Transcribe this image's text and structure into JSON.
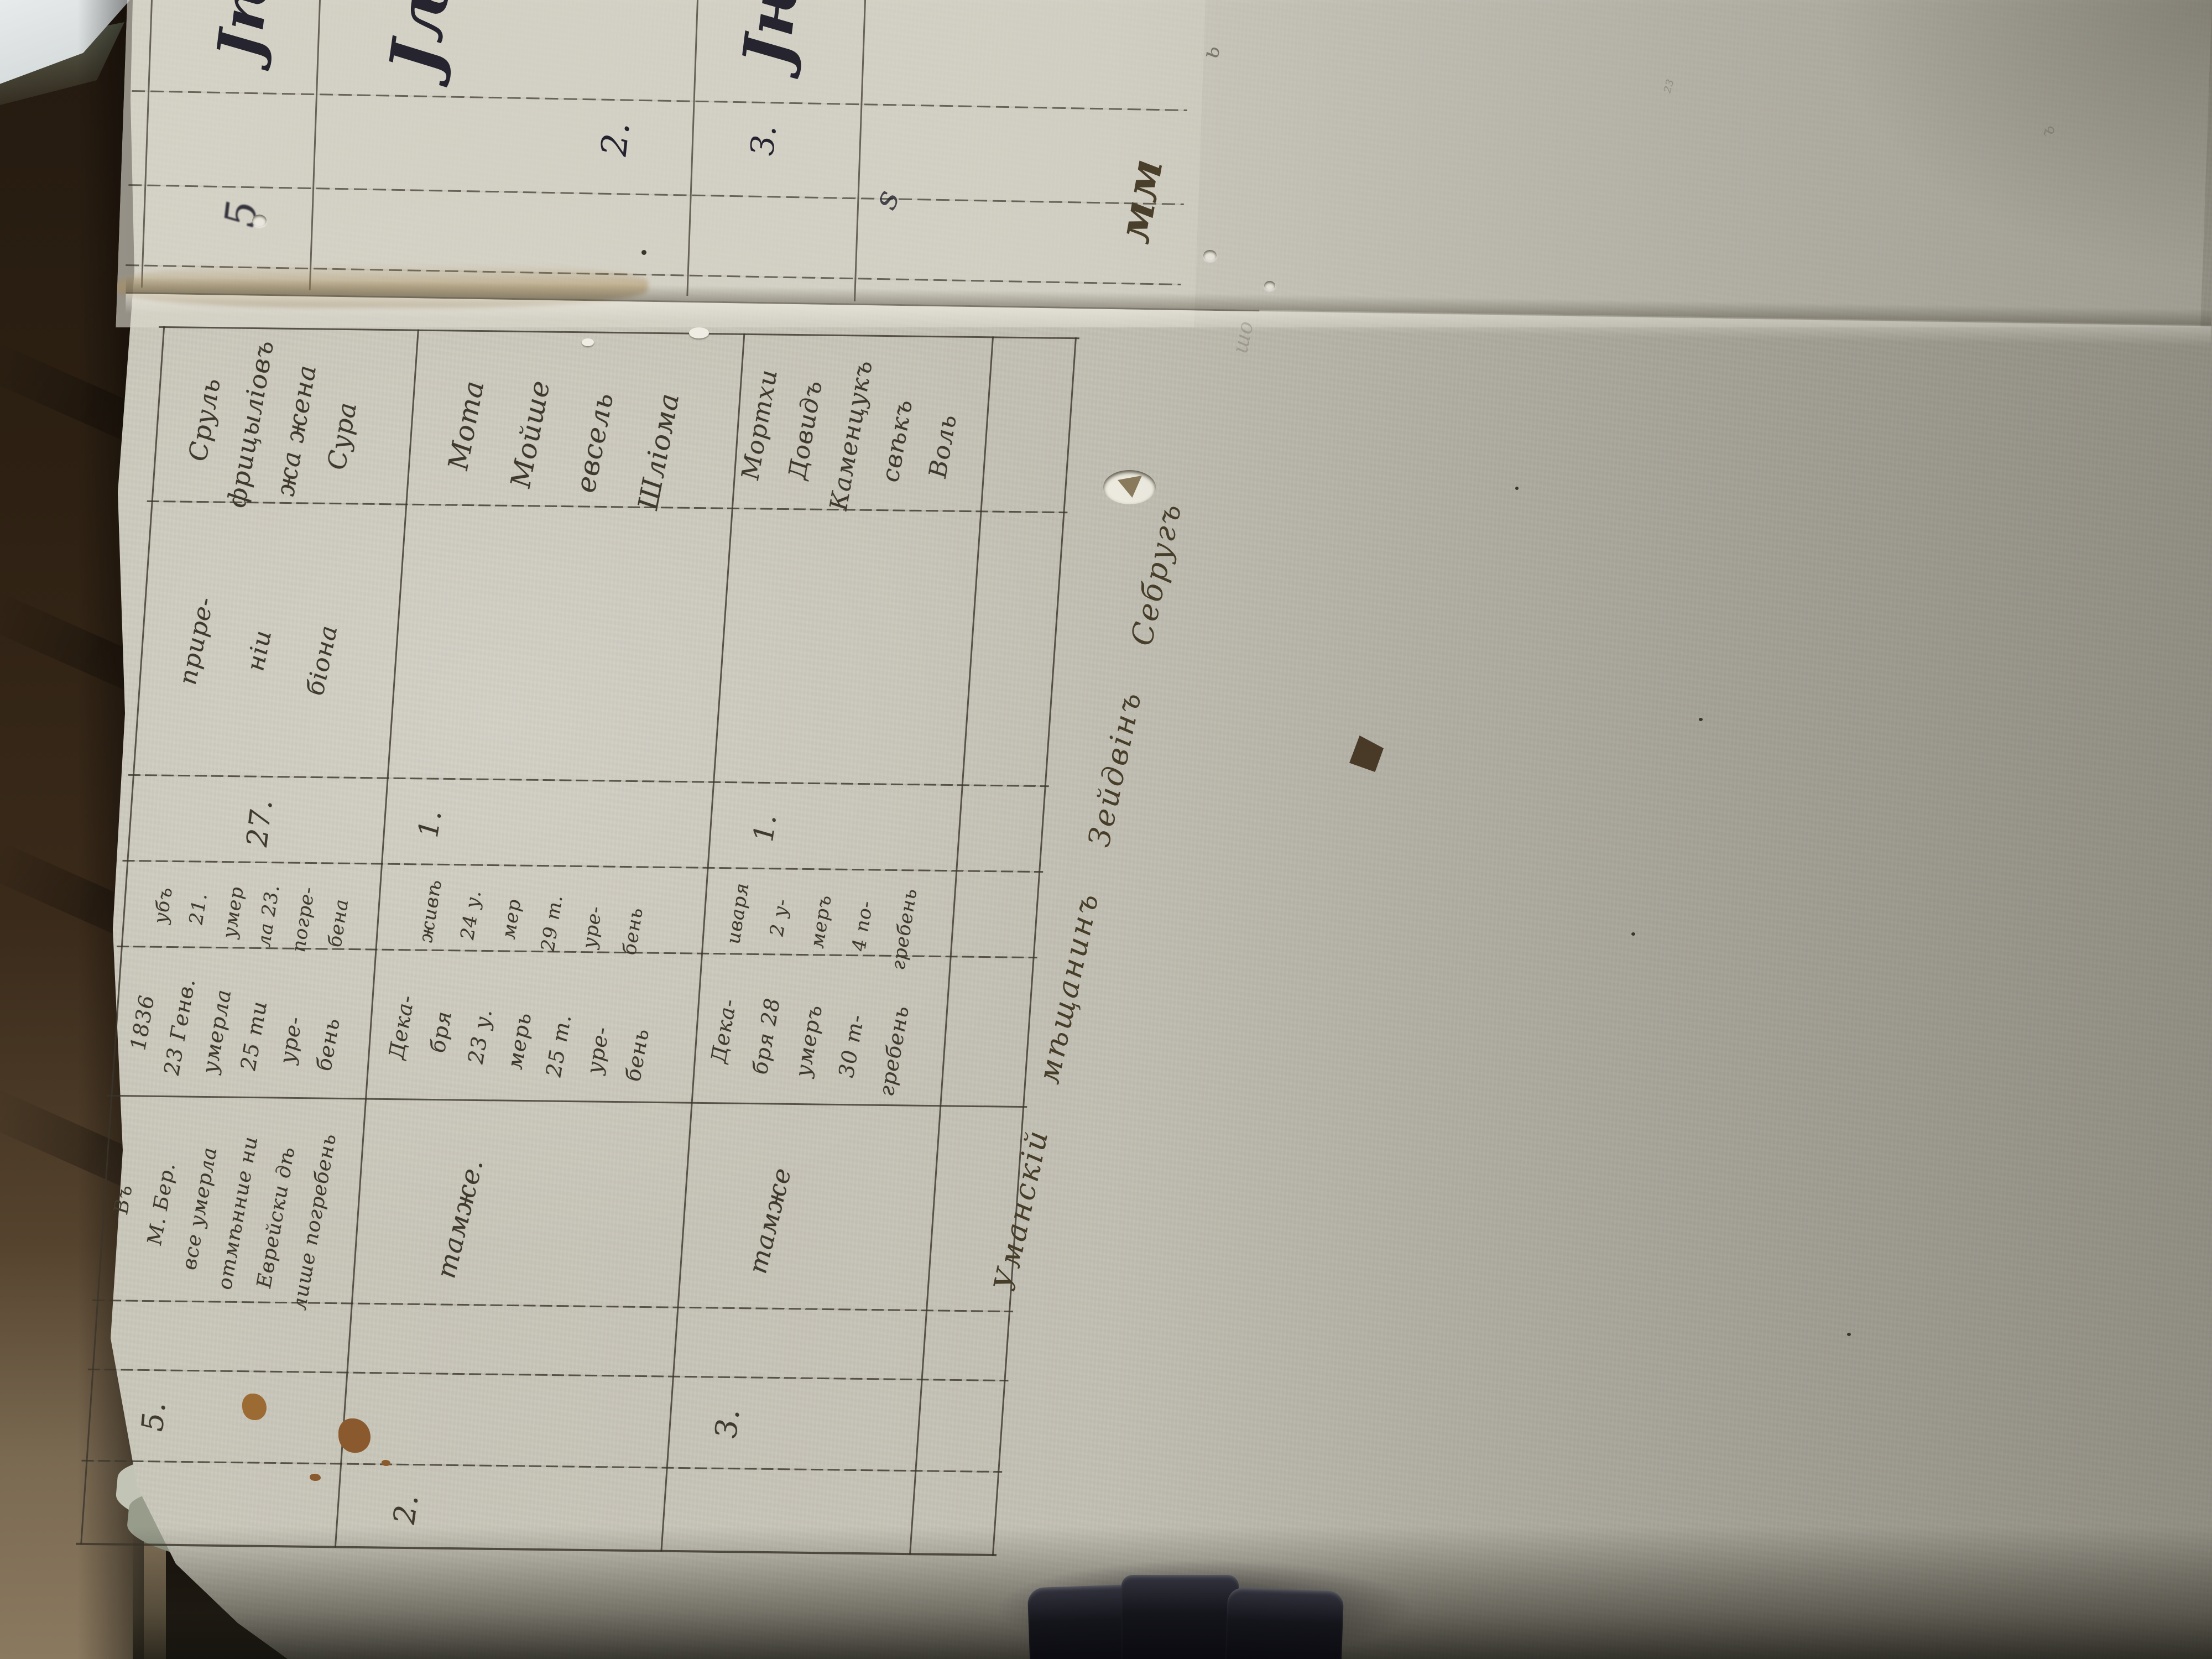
{
  "page": {
    "table": {
      "header": {
        "no": "5.",
        "place_lines": [
          "Въ",
          "М. Бер.",
          "все умерла",
          "отмѣнние ни",
          "Еврейски дѣ",
          "лише погребень"
        ],
        "death_lines": [
          "1836",
          "23 Генв.",
          "умерла",
          "25 ти",
          "уре-",
          "бень"
        ],
        "burial_lines": [
          "убъ",
          "21.",
          "умер",
          "ла 23.",
          "погре-",
          "бена"
        ],
        "count": "27.",
        "cause_lines": [
          "прире-",
          "ніи",
          "біона"
        ],
        "name_lines": [
          "Сруль",
          "фрицыліовъ",
          "жа жена",
          "Сура"
        ]
      },
      "rows": [
        {
          "no": "2.",
          "place": "тамже.",
          "death_lines": [
            "Дека-",
            "бря",
            "23 у.",
            "мерь",
            "25 т.",
            "уре-",
            "бень"
          ],
          "burial_lines": [
            "живѣ",
            "24 у.",
            "мер",
            "29 т.",
            "уре-",
            "бень"
          ],
          "count": "1.",
          "name_lines": [
            "Мота",
            "Мойше",
            "евсель",
            "Шліома"
          ]
        },
        {
          "no": "З.",
          "place": "тамже",
          "death_lines": [
            "Дека-",
            "бря 28",
            "умеръ",
            "30 т-",
            "гребень"
          ],
          "burial_lines": [
            "иваря",
            "2 у-",
            "меръ",
            "4 по-",
            "гребень"
          ],
          "count": "1.",
          "name_lines": [
            "Мортхи",
            "Довидъ",
            "Каменцукъ",
            "свѣкъ",
            "Воль"
          ]
        }
      ]
    },
    "top_strip": {
      "num_left": "2.",
      "num_right": "З.",
      "flourish1": "Јѣ",
      "flourish2": "Јљ",
      "flourish3": "Јњ",
      "smudge": "5",
      "curl": "ѕ"
    },
    "marginalia": {
      "inscription": "Уманскій мѣщанинъ Зейдвінъ Себругъ",
      "zigzag": "мм",
      "tick1": "ь",
      "tick2": "²³",
      "tick3": "ъ",
      "faded": "шо"
    }
  },
  "colors": {
    "paper": "#c6c3b7",
    "paper_top_strip": "#d8d5c9",
    "ink": "#3f3a2d",
    "ink_dark": "#23222e",
    "wood": "#3a2a1a",
    "clip_metal": "#14141b"
  }
}
